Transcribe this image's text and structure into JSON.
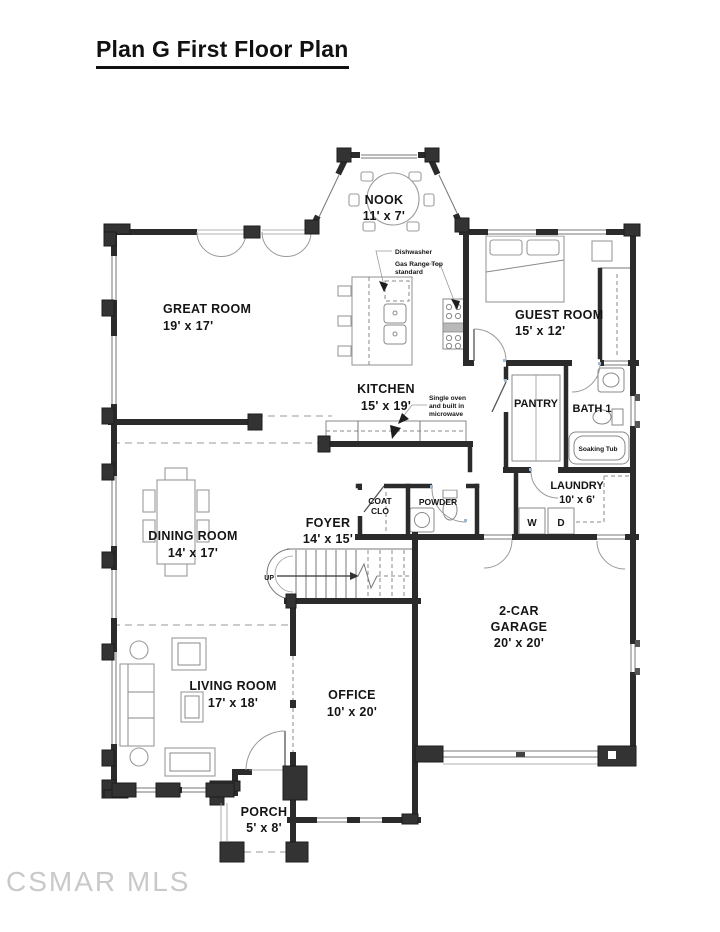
{
  "page": {
    "title": "Plan G First Floor Plan",
    "watermark": "CSMAR MLS"
  },
  "colors": {
    "wall": "#2b2b2b",
    "furniture_line": "#9b9b9b",
    "door_hinge_accent": "#9db8d2"
  },
  "rooms": {
    "nook": {
      "name": "NOOK",
      "dims": "11' x 7'"
    },
    "great_room": {
      "name": "GREAT ROOM",
      "dims": "19' x 17'"
    },
    "kitchen": {
      "name": "KITCHEN",
      "dims": "15' x 19'"
    },
    "guest_room": {
      "name": "GUEST ROOM",
      "dims": "15' x 12'"
    },
    "pantry": {
      "name": "PANTRY"
    },
    "bath_1": {
      "name": "BATH 1"
    },
    "laundry": {
      "name": "LAUNDRY",
      "dims": "10' x 6'"
    },
    "foyer": {
      "name": "FOYER",
      "dims": "14' x 15'"
    },
    "coat_closet": {
      "name_lines": [
        "COAT",
        "CLO"
      ]
    },
    "powder": {
      "name": "POWDER"
    },
    "dining_room": {
      "name": "DINING ROOM",
      "dims": "14' x 17'"
    },
    "living_room": {
      "name": "LIVING ROOM",
      "dims": "17' x 18'"
    },
    "office": {
      "name": "OFFICE",
      "dims": "10' x 20'"
    },
    "garage": {
      "name_lines": [
        "2-CAR",
        "GARAGE"
      ],
      "dims": "20' x 20'"
    },
    "porch": {
      "name": "PORCH",
      "dims": "5' x 8'"
    }
  },
  "annotations": {
    "dishwasher": "Dishwasher",
    "gas_range": [
      "Gas Range Top",
      "standard"
    ],
    "oven": [
      "Single oven",
      "and built in",
      "microwave"
    ],
    "soaking_tub": "Soaking Tub",
    "stairs_up": "UP",
    "washer": "W",
    "dryer": "D"
  }
}
